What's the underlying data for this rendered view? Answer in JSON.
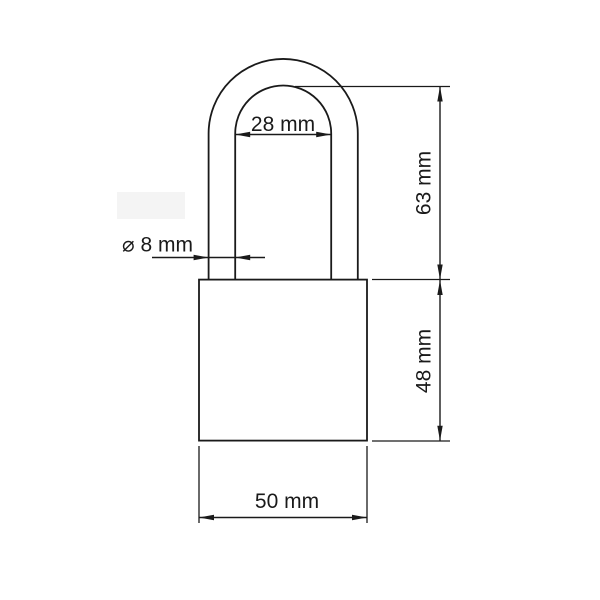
{
  "drawing": {
    "subject": "padlock-dimensional-drawing",
    "background_color": "#ffffff",
    "line_color": "#1a1a1a",
    "artifact_color": "#f4f4f4",
    "labels": {
      "shackle_inner_width": "28 mm",
      "shackle_diameter": "⌀ 8 mm",
      "shackle_height": "63 mm",
      "body_height": "48 mm",
      "body_width": "50 mm"
    }
  }
}
